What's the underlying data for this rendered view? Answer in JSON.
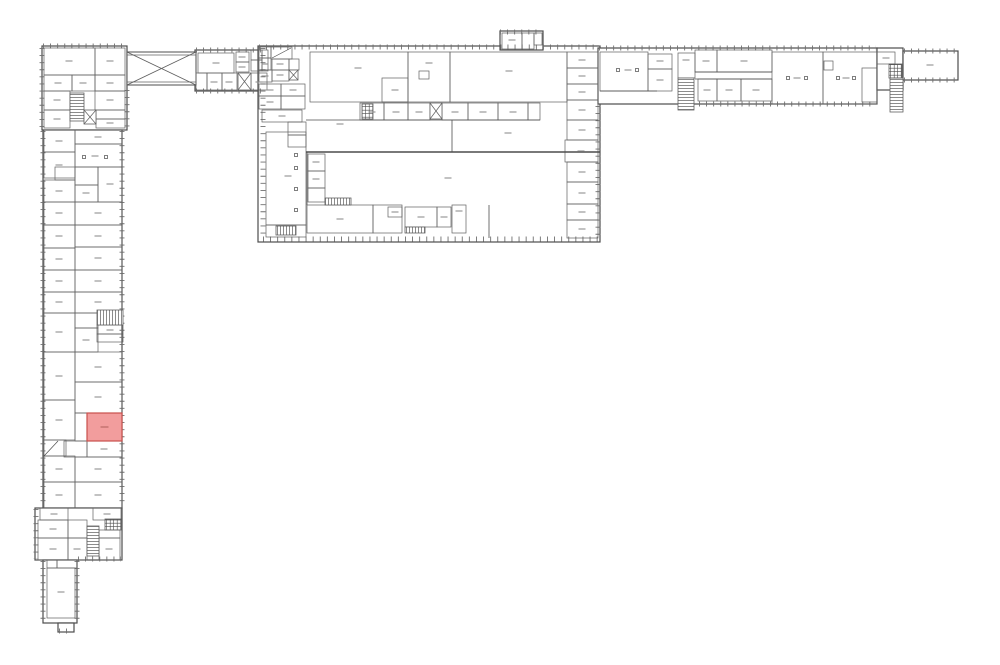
{
  "canvas": {
    "w": 1000,
    "h": 665,
    "bg": "#ffffff",
    "wall": "#4d4d4d",
    "thin": "#606060",
    "tick": "#6f6f6f",
    "label": "#8f8f8f"
  },
  "highlight_room": {
    "x": 87,
    "y": 413,
    "w": 35,
    "h": 28,
    "fill": "#f29d9d",
    "stroke": "#c9504c",
    "label_color": "#b96a66"
  },
  "blocks": [
    [
      42,
      46,
      85,
      84
    ],
    [
      43,
      130,
      79,
      378
    ],
    [
      35,
      508,
      87,
      52
    ],
    [
      43,
      560,
      34,
      63
    ],
    [
      58,
      623,
      16,
      9
    ],
    [
      195,
      50,
      73,
      41
    ],
    [
      258,
      46,
      342,
      196
    ],
    [
      500,
      31,
      43,
      19
    ],
    [
      598,
      48,
      279,
      56
    ],
    [
      877,
      48,
      26,
      42
    ],
    [
      903,
      51,
      55,
      29
    ]
  ],
  "ticks": [
    [
      42,
      48,
      42,
      129
    ],
    [
      43,
      131,
      43,
      507
    ],
    [
      36,
      509,
      36,
      559
    ],
    [
      43,
      561,
      43,
      622
    ],
    [
      77,
      561,
      77,
      622
    ],
    [
      122,
      131,
      122,
      507
    ],
    [
      127,
      90,
      127,
      129
    ],
    [
      43,
      46,
      126,
      46
    ],
    [
      78,
      559,
      121,
      559
    ],
    [
      59,
      631,
      73,
      631
    ],
    [
      196,
      50,
      267,
      50
    ],
    [
      196,
      91,
      267,
      91
    ],
    [
      259,
      47,
      599,
      47
    ],
    [
      263,
      48,
      263,
      237
    ],
    [
      263,
      239,
      598,
      239
    ],
    [
      500,
      32,
      542,
      32
    ],
    [
      599,
      48,
      876,
      48
    ],
    [
      699,
      104,
      876,
      104
    ],
    [
      904,
      51,
      957,
      51
    ],
    [
      904,
      80,
      957,
      80
    ],
    [
      598,
      106,
      598,
      238
    ]
  ],
  "bridge": {
    "x": 127,
    "y": 52,
    "w": 69,
    "h": 33
  },
  "rooms": [
    [
      44,
      48,
      51,
      27
    ],
    [
      95,
      48,
      30,
      27
    ],
    [
      44,
      75,
      28,
      16
    ],
    [
      72,
      75,
      23,
      16
    ],
    [
      95,
      75,
      30,
      16
    ],
    [
      44,
      91,
      26,
      19
    ],
    [
      44,
      110,
      26,
      18
    ],
    [
      95,
      91,
      30,
      19
    ],
    [
      96,
      110,
      29,
      9
    ],
    [
      96,
      119,
      29,
      9
    ],
    [
      75,
      130,
      47,
      14
    ],
    [
      44,
      130,
      31,
      22
    ],
    [
      44,
      152,
      31,
      26
    ],
    [
      55,
      167,
      20,
      13
    ],
    [
      44,
      180,
      31,
      22
    ],
    [
      44,
      202,
      31,
      23
    ],
    [
      44,
      225,
      31,
      23
    ],
    [
      44,
      248,
      31,
      22
    ],
    [
      44,
      270,
      31,
      22
    ],
    [
      44,
      292,
      31,
      21
    ],
    [
      44,
      313,
      31,
      39
    ],
    [
      44,
      352,
      31,
      48
    ],
    [
      44,
      400,
      31,
      40
    ],
    [
      44,
      440,
      22,
      16
    ],
    [
      44,
      456,
      31,
      26
    ],
    [
      44,
      482,
      31,
      26
    ],
    [
      75,
      144,
      47,
      23
    ],
    [
      75,
      167,
      23,
      18
    ],
    [
      98,
      167,
      24,
      35
    ],
    [
      75,
      185,
      23,
      17
    ],
    [
      75,
      202,
      47,
      23
    ],
    [
      75,
      225,
      47,
      22
    ],
    [
      75,
      247,
      47,
      23
    ],
    [
      75,
      270,
      47,
      22
    ],
    [
      75,
      292,
      47,
      21
    ],
    [
      75,
      313,
      23,
      15
    ],
    [
      97,
      325,
      26,
      9
    ],
    [
      97,
      334,
      26,
      8
    ],
    [
      75,
      328,
      23,
      24
    ],
    [
      75,
      352,
      47,
      30
    ],
    [
      75,
      382,
      47,
      31
    ],
    [
      75,
      413,
      12,
      28
    ],
    [
      87,
      441,
      35,
      16
    ],
    [
      64,
      441,
      23,
      16
    ],
    [
      75,
      457,
      47,
      25
    ],
    [
      75,
      482,
      47,
      26
    ],
    [
      40,
      508,
      28,
      12
    ],
    [
      93,
      508,
      28,
      12
    ],
    [
      38,
      520,
      30,
      18
    ],
    [
      38,
      538,
      30,
      22
    ],
    [
      68,
      520,
      19,
      18
    ],
    [
      68,
      538,
      19,
      22
    ],
    [
      99,
      530,
      21,
      8
    ],
    [
      99,
      538,
      21,
      22
    ],
    [
      47,
      560,
      10,
      8
    ],
    [
      57,
      560,
      20,
      8
    ],
    [
      47,
      568,
      28,
      50
    ],
    [
      259,
      47,
      12,
      11
    ],
    [
      271,
      47,
      21,
      12
    ],
    [
      259,
      58,
      12,
      12
    ],
    [
      272,
      59,
      17,
      11
    ],
    [
      289,
      59,
      10,
      11
    ],
    [
      259,
      70,
      13,
      12
    ],
    [
      272,
      70,
      17,
      11
    ],
    [
      259,
      84,
      22,
      12
    ],
    [
      259,
      96,
      22,
      13
    ],
    [
      281,
      84,
      24,
      12
    ],
    [
      281,
      96,
      24,
      13
    ],
    [
      262,
      110,
      40,
      12
    ],
    [
      288,
      122,
      18,
      13
    ],
    [
      288,
      135,
      18,
      12
    ],
    [
      198,
      53,
      36,
      20
    ],
    [
      236,
      52,
      13,
      10
    ],
    [
      236,
      62,
      13,
      10
    ],
    [
      251,
      50,
      11,
      10
    ],
    [
      251,
      60,
      11,
      11
    ],
    [
      262,
      50,
      6,
      21
    ],
    [
      196,
      73,
      11,
      17
    ],
    [
      207,
      73,
      15,
      17
    ],
    [
      222,
      73,
      15,
      17
    ],
    [
      251,
      73,
      16,
      17
    ],
    [
      310,
      52,
      98,
      50
    ],
    [
      382,
      78,
      26,
      24
    ],
    [
      408,
      52,
      42,
      50
    ],
    [
      419,
      71,
      10,
      8
    ],
    [
      450,
      52,
      117,
      50
    ],
    [
      360,
      103,
      24,
      17
    ],
    [
      384,
      103,
      24,
      17
    ],
    [
      408,
      103,
      22,
      17
    ],
    [
      442,
      103,
      26,
      17
    ],
    [
      468,
      103,
      30,
      17
    ],
    [
      498,
      103,
      30,
      17
    ],
    [
      528,
      103,
      12,
      17
    ],
    [
      266,
      132,
      40,
      93
    ],
    [
      266,
      225,
      40,
      12
    ],
    [
      308,
      154,
      17,
      17
    ],
    [
      308,
      171,
      17,
      17
    ],
    [
      308,
      188,
      17,
      14
    ],
    [
      307,
      205,
      66,
      28
    ],
    [
      373,
      205,
      29,
      28
    ],
    [
      388,
      207,
      14,
      10
    ],
    [
      405,
      207,
      32,
      20
    ],
    [
      437,
      207,
      14,
      20
    ],
    [
      452,
      205,
      14,
      28
    ],
    [
      567,
      52,
      31,
      16
    ],
    [
      567,
      68,
      31,
      16
    ],
    [
      567,
      84,
      31,
      16
    ],
    [
      567,
      100,
      31,
      20
    ],
    [
      567,
      120,
      31,
      20
    ],
    [
      565,
      140,
      33,
      22
    ],
    [
      567,
      162,
      31,
      20
    ],
    [
      567,
      182,
      31,
      22
    ],
    [
      567,
      204,
      31,
      16
    ],
    [
      567,
      220,
      31,
      18
    ],
    [
      600,
      52,
      48,
      39
    ],
    [
      648,
      54,
      24,
      15
    ],
    [
      648,
      69,
      24,
      22
    ],
    [
      678,
      53,
      17,
      25
    ],
    [
      695,
      50,
      22,
      22
    ],
    [
      717,
      50,
      55,
      22
    ],
    [
      698,
      79,
      19,
      22
    ],
    [
      717,
      79,
      24,
      22
    ],
    [
      741,
      79,
      31,
      22
    ],
    [
      772,
      52,
      51,
      52
    ],
    [
      823,
      52,
      54,
      52
    ],
    [
      862,
      68,
      15,
      34
    ],
    [
      824,
      61,
      9,
      9
    ],
    [
      877,
      52,
      18,
      12
    ],
    [
      502,
      33,
      20,
      16
    ],
    [
      522,
      33,
      12,
      16
    ],
    [
      534,
      33,
      8,
      12
    ]
  ],
  "walls": [
    [
      306,
      120,
      540,
      120,
      0.8
    ],
    [
      452,
      120,
      452,
      152,
      0.8
    ],
    [
      306,
      152,
      600,
      152,
      1.4
    ],
    [
      307,
      152,
      307,
      205,
      0.8
    ],
    [
      489,
      205,
      489,
      238,
      0.8
    ],
    [
      695,
      72,
      772,
      72,
      0.8
    ],
    [
      695,
      79,
      772,
      79,
      0.8
    ],
    [
      600,
      91,
      657,
      91,
      0.8
    ],
    [
      272,
      58,
      291,
      48,
      0.7
    ],
    [
      44,
      456,
      58,
      441,
      0.7
    ]
  ],
  "stairs": [
    {
      "x": 70,
      "y": 93,
      "w": 14,
      "h": 28,
      "dir": "v"
    },
    {
      "x": 97,
      "y": 310,
      "w": 26,
      "h": 15,
      "dir": "h"
    },
    {
      "x": 87,
      "y": 526,
      "w": 12,
      "h": 30,
      "dir": "v"
    },
    {
      "x": 276,
      "y": 226,
      "w": 20,
      "h": 9,
      "dir": "h"
    },
    {
      "x": 325,
      "y": 198,
      "w": 26,
      "h": 7,
      "dir": "h"
    },
    {
      "x": 405,
      "y": 227,
      "w": 20,
      "h": 6,
      "dir": "h"
    },
    {
      "x": 678,
      "y": 78,
      "w": 16,
      "h": 32,
      "dir": "v"
    },
    {
      "x": 890,
      "y": 78,
      "w": 13,
      "h": 34,
      "dir": "v"
    }
  ],
  "xboxes": [
    [
      84,
      110,
      12,
      14
    ],
    [
      289,
      70,
      9,
      10
    ],
    [
      238,
      73,
      13,
      17
    ],
    [
      430,
      103,
      12,
      16
    ]
  ],
  "gridboxes": [
    [
      105,
      519,
      16,
      11
    ],
    [
      889,
      64,
      13,
      14
    ],
    [
      362,
      104,
      11,
      15
    ]
  ],
  "columns": [
    [
      84,
      157
    ],
    [
      106,
      157
    ],
    [
      296,
      155
    ],
    [
      296,
      168
    ],
    [
      296,
      189
    ],
    [
      296,
      210
    ],
    [
      618,
      70
    ],
    [
      637,
      70
    ],
    [
      788,
      78
    ],
    [
      806,
      78
    ],
    [
      838,
      78
    ],
    [
      854,
      78
    ]
  ],
  "dashes": [
    [
      69,
      61
    ],
    [
      110,
      61
    ],
    [
      58,
      83
    ],
    [
      83,
      83
    ],
    [
      110,
      83
    ],
    [
      57,
      100
    ],
    [
      57,
      119
    ],
    [
      110,
      100
    ],
    [
      110,
      123
    ],
    [
      98,
      137
    ],
    [
      59,
      141
    ],
    [
      59,
      165
    ],
    [
      59,
      191
    ],
    [
      59,
      213
    ],
    [
      59,
      236
    ],
    [
      59,
      259
    ],
    [
      59,
      281
    ],
    [
      59,
      302
    ],
    [
      59,
      332
    ],
    [
      59,
      376
    ],
    [
      59,
      420
    ],
    [
      59,
      469
    ],
    [
      59,
      495
    ],
    [
      95,
      156
    ],
    [
      110,
      184
    ],
    [
      86,
      193
    ],
    [
      98,
      213
    ],
    [
      98,
      236
    ],
    [
      98,
      258
    ],
    [
      98,
      281
    ],
    [
      98,
      302
    ],
    [
      86,
      340
    ],
    [
      110,
      330
    ],
    [
      98,
      367
    ],
    [
      98,
      397
    ],
    [
      104,
      449
    ],
    [
      98,
      469
    ],
    [
      98,
      495
    ],
    [
      54,
      514
    ],
    [
      107,
      514
    ],
    [
      53,
      529
    ],
    [
      53,
      549
    ],
    [
      77,
      549
    ],
    [
      109,
      549
    ],
    [
      61,
      592
    ],
    [
      216,
      63
    ],
    [
      242,
      57
    ],
    [
      242,
      67
    ],
    [
      214,
      82
    ],
    [
      229,
      82
    ],
    [
      259,
      82
    ],
    [
      265,
      64
    ],
    [
      280,
      64
    ],
    [
      265,
      76
    ],
    [
      280,
      75
    ],
    [
      270,
      90
    ],
    [
      270,
      102
    ],
    [
      293,
      90
    ],
    [
      282,
      116
    ],
    [
      358,
      68
    ],
    [
      395,
      90
    ],
    [
      429,
      63
    ],
    [
      509,
      71
    ],
    [
      372,
      112
    ],
    [
      396,
      112
    ],
    [
      419,
      112
    ],
    [
      455,
      112
    ],
    [
      483,
      112
    ],
    [
      513,
      112
    ],
    [
      340,
      124
    ],
    [
      508,
      133
    ],
    [
      288,
      176
    ],
    [
      316,
      162
    ],
    [
      316,
      179
    ],
    [
      448,
      178
    ],
    [
      340,
      219
    ],
    [
      395,
      212
    ],
    [
      421,
      217
    ],
    [
      444,
      217
    ],
    [
      459,
      211
    ],
    [
      582,
      60
    ],
    [
      582,
      76
    ],
    [
      582,
      92
    ],
    [
      582,
      110
    ],
    [
      582,
      130
    ],
    [
      581,
      151
    ],
    [
      582,
      172
    ],
    [
      582,
      193
    ],
    [
      582,
      212
    ],
    [
      582,
      229
    ],
    [
      628,
      70
    ],
    [
      660,
      61
    ],
    [
      660,
      80
    ],
    [
      686,
      60
    ],
    [
      706,
      61
    ],
    [
      744,
      61
    ],
    [
      707,
      90
    ],
    [
      729,
      90
    ],
    [
      756,
      90
    ],
    [
      797,
      78
    ],
    [
      846,
      78
    ],
    [
      886,
      58
    ],
    [
      930,
      65
    ],
    [
      512,
      40
    ]
  ]
}
